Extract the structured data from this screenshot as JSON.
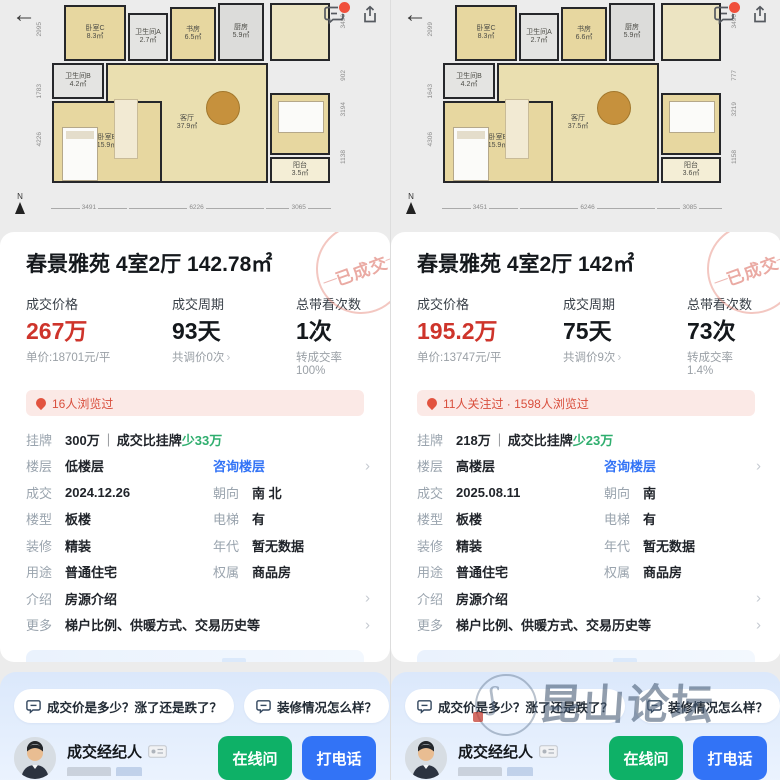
{
  "glyphs": {
    "chevron": "›",
    "back_arrow": "←",
    "compass_n": "N"
  },
  "colors": {
    "price_red": "#ce342b",
    "link_blue": "#3273f6",
    "diff_green": "#2fae6e",
    "btn_green": "#0eb167",
    "btn_blue": "#3273f6",
    "hot_bg": "#fbe9e6",
    "hot_text": "#d94f3d"
  },
  "watermark_forum": "昆山论坛",
  "panels": [
    {
      "floorplan": {
        "rooms": [
          {
            "name": "卧室C",
            "area": "8.3㎡"
          },
          {
            "name": "卫生间A",
            "area": "2.7㎡"
          },
          {
            "name": "书房",
            "area": "6.5㎡"
          },
          {
            "name": "厨房",
            "area": "5.9㎡"
          },
          {
            "name": "卫生间B",
            "area": "4.2㎡"
          },
          {
            "name": "卧室B",
            "area": "15.9㎡"
          },
          {
            "name": "客厅",
            "area": "37.9㎡"
          },
          {
            "name": "卧室A",
            "area": "8.8㎡"
          },
          {
            "name": "阳台",
            "area": "3.5㎡"
          }
        ],
        "dims_left": [
          "2995",
          "1783",
          "4226"
        ],
        "dims_right": [
          "3490",
          "902",
          "3194",
          "1138"
        ],
        "dims_bottom": [
          "3491",
          "6226",
          "3065"
        ]
      },
      "stamp": "已成交",
      "title": "春景雅苑 4室2厅 142.78㎡",
      "stats": [
        {
          "label": "成交价格",
          "value": "267万",
          "sub": "单价:18701元/平"
        },
        {
          "label": "成交周期",
          "value": "93天",
          "sub": "共调价0次"
        },
        {
          "label": "总带看次数",
          "value": "1次",
          "sub": "转成交率100%"
        }
      ],
      "hot": "16人浏览过",
      "details": [
        {
          "cells": [
            {
              "label": "挂牌",
              "value": "300万",
              "sep": "｜",
              "compare": "成交比挂牌",
              "diff": "少33万"
            }
          ]
        },
        {
          "cells": [
            {
              "label": "楼层",
              "value": "低楼层"
            },
            {
              "link": "咨询楼层"
            }
          ],
          "chevron": true
        },
        {
          "cells": [
            {
              "label": "成交",
              "value": "2024.12.26"
            },
            {
              "label": "朝向",
              "value": "南 北"
            }
          ]
        },
        {
          "cells": [
            {
              "label": "楼型",
              "value": "板楼"
            },
            {
              "label": "电梯",
              "value": "有"
            }
          ]
        },
        {
          "cells": [
            {
              "label": "装修",
              "value": "精装"
            },
            {
              "label": "年代",
              "value": "暂无数据"
            }
          ]
        },
        {
          "cells": [
            {
              "label": "用途",
              "value": "普通住宅"
            },
            {
              "label": "权属",
              "value": "商品房"
            }
          ]
        },
        {
          "cells": [
            {
              "label": "介绍",
              "value": "房源介绍"
            }
          ],
          "chevron": true
        },
        {
          "cells": [
            {
              "label": "更多",
              "value": "梯户比例、供暖方式、交易历史等"
            }
          ],
          "chevron": true
        }
      ],
      "sell_banner": {
        "text": "在线发布房源 享专业委托服务",
        "action": "我要卖房"
      },
      "chips": [
        "成交价是多少？涨了还是跌了？",
        "装修情况怎么样？"
      ],
      "agent": {
        "title": "成交经纪人",
        "buttons": [
          "在线问",
          "打电话"
        ]
      }
    },
    {
      "floorplan": {
        "rooms": [
          {
            "name": "卧室C",
            "area": "8.3㎡"
          },
          {
            "name": "卫生间A",
            "area": "2.7㎡"
          },
          {
            "name": "书房",
            "area": "6.6㎡"
          },
          {
            "name": "厨房",
            "area": "5.9㎡"
          },
          {
            "name": "卫生间B",
            "area": "4.2㎡"
          },
          {
            "name": "卧室B",
            "area": "15.9㎡"
          },
          {
            "name": "客厅",
            "area": "37.5㎡"
          },
          {
            "name": "卧室A",
            "area": "8.8㎡"
          },
          {
            "name": "阳台",
            "area": "3.6㎡"
          }
        ],
        "dims_left": [
          "2999",
          "1643",
          "4306"
        ],
        "dims_right": [
          "3490",
          "777",
          "3219",
          "1158"
        ],
        "dims_bottom": [
          "3451",
          "6246",
          "3085"
        ]
      },
      "stamp": "已成交",
      "title": "春景雅苑 4室2厅 142㎡",
      "stats": [
        {
          "label": "成交价格",
          "value": "195.2万",
          "sub": "单价:13747元/平"
        },
        {
          "label": "成交周期",
          "value": "75天",
          "sub": "共调价9次"
        },
        {
          "label": "总带看次数",
          "value": "73次",
          "sub": "转成交率1.4%"
        }
      ],
      "hot": "11人关注过 · 1598人浏览过",
      "details": [
        {
          "cells": [
            {
              "label": "挂牌",
              "value": "218万",
              "sep": "｜",
              "compare": "成交比挂牌",
              "diff": "少23万"
            }
          ]
        },
        {
          "cells": [
            {
              "label": "楼层",
              "value": "高楼层"
            },
            {
              "link": "咨询楼层"
            }
          ],
          "chevron": true
        },
        {
          "cells": [
            {
              "label": "成交",
              "value": "2025.08.11"
            },
            {
              "label": "朝向",
              "value": "南"
            }
          ]
        },
        {
          "cells": [
            {
              "label": "楼型",
              "value": "板楼"
            },
            {
              "label": "电梯",
              "value": "有"
            }
          ]
        },
        {
          "cells": [
            {
              "label": "装修",
              "value": "精装"
            },
            {
              "label": "年代",
              "value": "暂无数据"
            }
          ]
        },
        {
          "cells": [
            {
              "label": "用途",
              "value": "普通住宅"
            },
            {
              "label": "权属",
              "value": "商品房"
            }
          ]
        },
        {
          "cells": [
            {
              "label": "介绍",
              "value": "房源介绍"
            }
          ],
          "chevron": true
        },
        {
          "cells": [
            {
              "label": "更多",
              "value": "梯户比例、供暖方式、交易历史等"
            }
          ],
          "chevron": true
        }
      ],
      "sell_banner": {
        "text": "在线发布房源 享专业委托服务",
        "action": "我要卖房"
      },
      "chips": [
        "成交价是多少？涨了还是跌了？",
        "装修情况怎么样？"
      ],
      "agent": {
        "title": "成交经纪人",
        "buttons": [
          "在线问",
          "打电话"
        ]
      },
      "has_watermark": true
    }
  ]
}
